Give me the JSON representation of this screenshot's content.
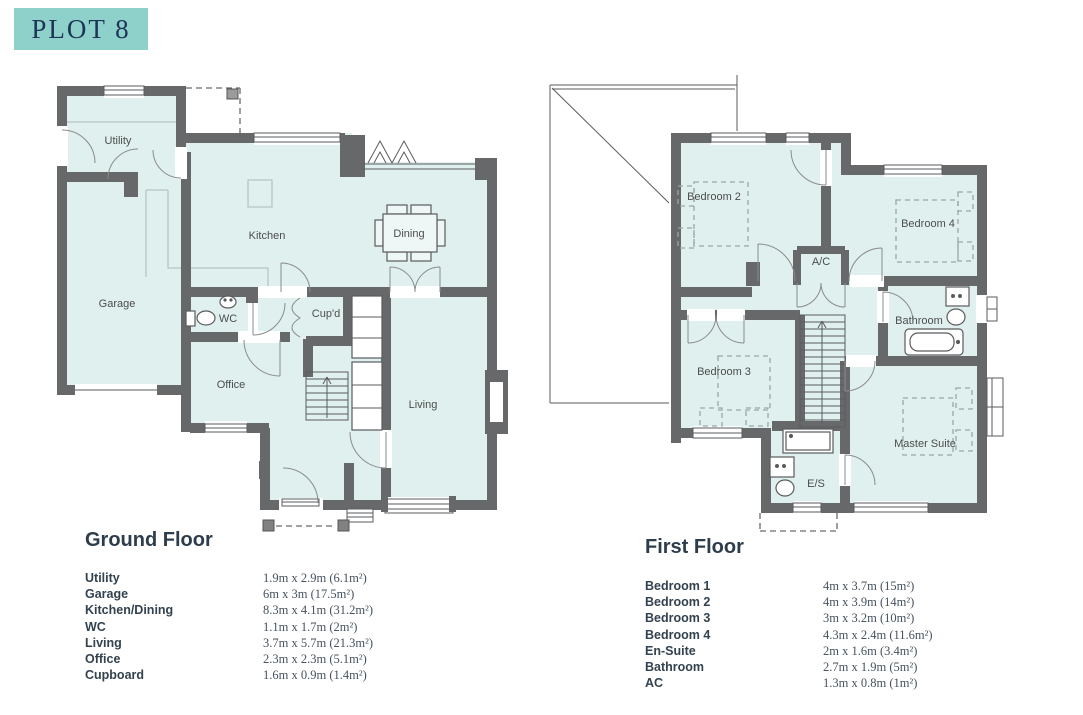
{
  "title": "PLOT 8",
  "colors": {
    "accent_teal": "#8ed1ca",
    "title_text": "#1d3557",
    "wall": "#67686a",
    "room_fill": "#dff0ee",
    "heading_text": "#2e3d4c"
  },
  "ground_floor": {
    "heading": "Ground Floor",
    "labels": {
      "utility": "Utility",
      "garage": "Garage",
      "kitchen": "Kitchen",
      "dining": "Dining",
      "wc": "WC",
      "cupd": "Cup'd",
      "office": "Office",
      "living": "Living"
    },
    "rooms": [
      {
        "name": "Utility",
        "dims": "1.9m x 2.9m (6.1m²)"
      },
      {
        "name": "Garage",
        "dims": "6m x 3m (17.5m²)"
      },
      {
        "name": "Kitchen/Dining",
        "dims": "8.3m x 4.1m (31.2m²)"
      },
      {
        "name": "WC",
        "dims": "1.1m x 1.7m (2m²)"
      },
      {
        "name": "Living",
        "dims": "3.7m x 5.7m (21.3m²)"
      },
      {
        "name": "Office",
        "dims": "2.3m x 2.3m (5.1m²)"
      },
      {
        "name": "Cupboard",
        "dims": "1.6m x 0.9m (1.4m²)"
      }
    ]
  },
  "first_floor": {
    "heading": "First Floor",
    "labels": {
      "bedroom2": "Bedroom 2",
      "bedroom3": "Bedroom 3",
      "bedroom4": "Bedroom 4",
      "ac": "A/C",
      "bathroom": "Bathroom",
      "master": "Master Suite",
      "es": "E/S"
    },
    "rooms": [
      {
        "name": "Bedroom 1",
        "dims": "4m x 3.7m (15m²)"
      },
      {
        "name": "Bedroom 2",
        "dims": "4m x 3.9m (14m²)"
      },
      {
        "name": "Bedroom 3",
        "dims": "3m x 3.2m (10m²)"
      },
      {
        "name": "Bedroom 4",
        "dims": "4.3m x 2.4m (11.6m²)"
      },
      {
        "name": "En-Suite",
        "dims": "2m x 1.6m (3.4m²)"
      },
      {
        "name": "Bathroom",
        "dims": "2.7m x 1.9m (5m²)"
      },
      {
        "name": "AC",
        "dims": "1.3m x 0.8m (1m²)"
      }
    ]
  }
}
